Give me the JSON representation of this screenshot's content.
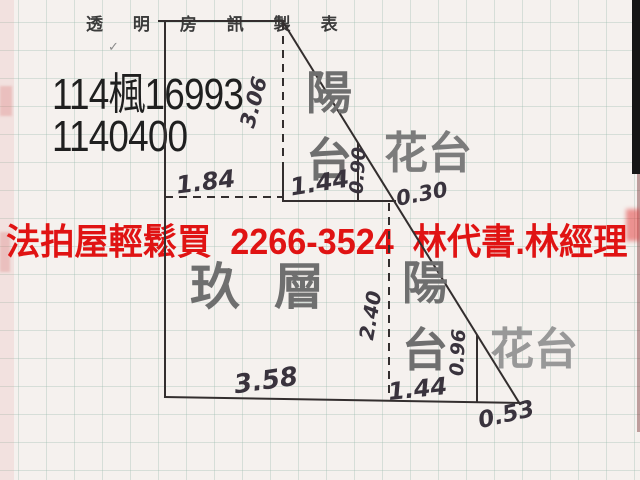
{
  "header": {
    "title": "透 明 房 訊 製 表"
  },
  "case_info": {
    "case_number": "114楓16993",
    "code": "1140400"
  },
  "ad_banner": {
    "text": "法拍屋輕鬆買  2266-3524  林代書.林經理",
    "phone": "2266-3524",
    "color": "#e01313"
  },
  "floor_plan": {
    "floor_label": "玖層",
    "balcony_top_label": "陽台",
    "flower_top_label": "花台",
    "balcony_right_label": "陽台",
    "flower_bottom_label": "花台",
    "dims": {
      "top_left_width": "1.84",
      "notch_width": "1.44",
      "notch_height": "0.90",
      "right_top_height": "3.06",
      "edge_offset": "0.30",
      "inner_height": "2.40",
      "bottom_left_width": "3.58",
      "bottom_mid_width": "1.44",
      "flower_height": "0.96",
      "bottom_tip_width": "0.53"
    }
  },
  "colors": {
    "ad_red": "#e01313",
    "ink": "#332e2e",
    "stamp_gray": "#6f6f6f",
    "paper": "#f5f1ee"
  }
}
